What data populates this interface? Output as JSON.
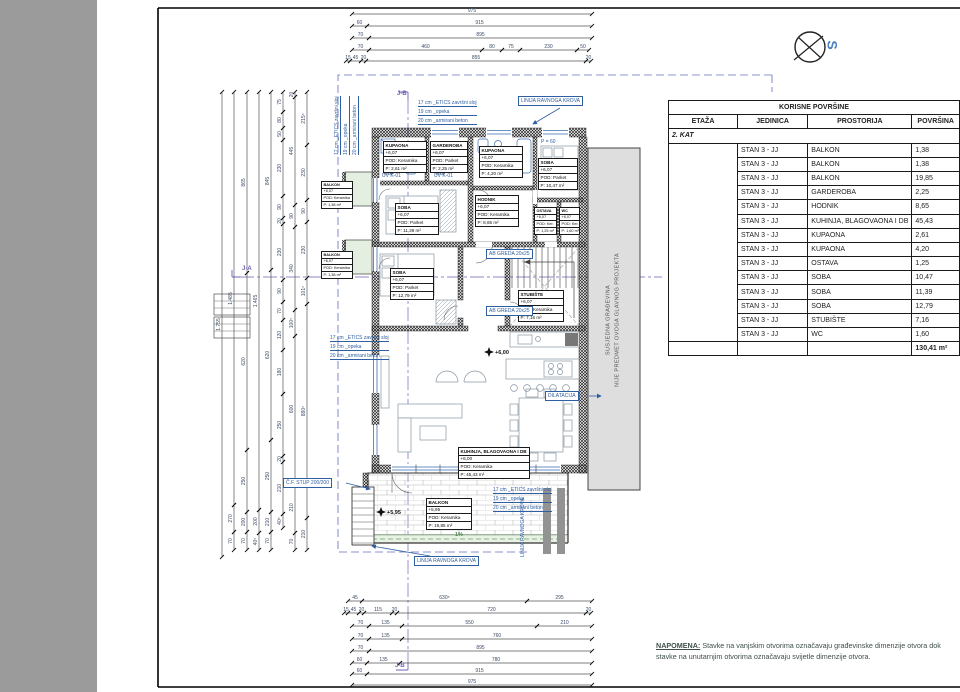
{
  "compass": {
    "label": "S"
  },
  "table": {
    "title": "KORISNE POVRŠINE",
    "headers": [
      "ETAŽA",
      "JEDINICA",
      "PROSTORIJA",
      "POVRŠINA"
    ],
    "section": "2. KAT",
    "rows": [
      {
        "unit": "STAN 3 - JJ",
        "room": "BALKON",
        "area": "1,38"
      },
      {
        "unit": "STAN 3 - JJ",
        "room": "BALKON",
        "area": "1,38"
      },
      {
        "unit": "STAN 3 - JJ",
        "room": "BALKON",
        "area": "19,85"
      },
      {
        "unit": "STAN 3 - JJ",
        "room": "GARDEROBA",
        "area": "2,25"
      },
      {
        "unit": "STAN 3 - JJ",
        "room": "HODNIK",
        "area": "8,65"
      },
      {
        "unit": "STAN 3 - JJ",
        "room": "KUHINJA, BLAGOVAONA I DB",
        "area": "45,43"
      },
      {
        "unit": "STAN 3 - JJ",
        "room": "KUPAONA",
        "area": "2,61"
      },
      {
        "unit": "STAN 3 - JJ",
        "room": "KUPAONA",
        "area": "4,20"
      },
      {
        "unit": "STAN 3 - JJ",
        "room": "OSTAVA",
        "area": "1,25"
      },
      {
        "unit": "STAN 3 - JJ",
        "room": "SOBA",
        "area": "10,47"
      },
      {
        "unit": "STAN 3 - JJ",
        "room": "SOBA",
        "area": "11,39"
      },
      {
        "unit": "STAN 3 - JJ",
        "room": "SOBA",
        "area": "12,79"
      },
      {
        "unit": "STAN 3 - JJ",
        "room": "STUBIŠTE",
        "area": "7,16"
      },
      {
        "unit": "STAN 3 - JJ",
        "room": "WC",
        "area": "1,60"
      }
    ],
    "total": "130,41 m²",
    "total_color": "#ee5a70"
  },
  "note": {
    "label": "NAPOMENA:",
    "text": " Stavke na vanjskim otvorima označavaju građevinske dimenzije otvora dok stavke na unutarnjim otvorima označavaju svijetle dimenzije otvora."
  },
  "plan": {
    "neighbor": {
      "line1": "SUSJEDNA GRAĐEVINA",
      "line2": "NIJE PREDMET OVOGA GLAVNOG PROJEKTA"
    },
    "slope": {
      "text": "1%"
    },
    "levels": [
      {
        "x": 489,
        "y": 352,
        "t": "+6,00"
      },
      {
        "x": 381,
        "y": 512,
        "t": "+5,95"
      }
    ],
    "sections": [
      {
        "text": "J-A",
        "x": 242,
        "y": 266
      },
      {
        "text": "J-B",
        "x": 397,
        "y": 91
      },
      {
        "text": "J-B",
        "x": 395,
        "y": 663
      }
    ],
    "room_labels": [
      {
        "x": 383,
        "y": 141,
        "w": 42,
        "name": "KUPAONA",
        "level": "+6,07",
        "floor": "POD: Keramika",
        "area": "P: 2,61 m²"
      },
      {
        "x": 430,
        "y": 141,
        "w": 36,
        "name": "GARDEROBA",
        "level": "+6,07",
        "floor": "POD: Parket",
        "area": "P: 2,25 m²"
      },
      {
        "x": 479,
        "y": 146,
        "w": 42,
        "name": "KUPAONA",
        "level": "+6,07",
        "floor": "POD: Keramika",
        "area": "P: 4,20 m²"
      },
      {
        "x": 538,
        "y": 158,
        "w": 38,
        "name": "SOBA",
        "level": "+6,07",
        "floor": "POD: Parket",
        "area": "P: 10,47 m²"
      },
      {
        "x": 395,
        "y": 203,
        "w": 42,
        "name": "SOBA",
        "level": "+6,07",
        "floor": "POD: Parket",
        "area": "P: 11,39 m²"
      },
      {
        "x": 390,
        "y": 268,
        "w": 42,
        "name": "SOBA",
        "level": "+6,07",
        "floor": "POD: Parket",
        "area": "P: 12,79 m²"
      },
      {
        "x": 475,
        "y": 195,
        "w": 42,
        "name": "HODNIK",
        "level": "+6,07",
        "floor": "POD: Keramika",
        "area": "P: 8,65 m²"
      },
      {
        "x": 518,
        "y": 290,
        "w": 44,
        "name": "STUBIŠTE",
        "level": "+6,07",
        "floor": "POD: Keramika",
        "area": "P: 7,16 m²"
      },
      {
        "x": 534,
        "y": 207,
        "w": 21,
        "fs": 3.8,
        "name": "OSTAVA",
        "level": "+6,07",
        "floor": "POD: Ker.",
        "area": "P: 1,25 m²"
      },
      {
        "x": 559,
        "y": 207,
        "w": 19,
        "fs": 3.8,
        "name": "WC",
        "level": "+6,07",
        "floor": "POD: Ker.",
        "area": "P: 1,60 m²"
      },
      {
        "x": 458,
        "y": 447,
        "w": 70,
        "name": "KUHINJA, BLAGOVAONA I DB",
        "level": "+6,00",
        "floor": "POD: Keramika",
        "area": "P: 45,43 m²"
      },
      {
        "x": 426,
        "y": 498,
        "w": 44,
        "name": "BALKON",
        "level": "+5,95",
        "floor": "POD: Keramika",
        "area": "P: 19,85 m²"
      },
      {
        "x": 321,
        "y": 181,
        "w": 30,
        "fs": 3.8,
        "name": "BALKON",
        "level": "+6,07",
        "floor": "POD: Keramika",
        "area": "P: 1,38 m²"
      },
      {
        "x": 321,
        "y": 251,
        "w": 30,
        "fs": 3.8,
        "name": "BALKON",
        "level": "+6,07",
        "floor": "POD: Keramika",
        "area": "P: 1,38 m²"
      }
    ],
    "callouts": [
      {
        "type": "box",
        "x": 518,
        "y": 96,
        "text": "LINIJA RAVNOGA KROVA"
      },
      {
        "type": "box",
        "x": 414,
        "y": 556,
        "text": "LINIJA RAVNOGA KROVA"
      },
      {
        "type": "vert",
        "x": 520,
        "y": 498,
        "text": "LINIJA RAVNOGA KROVA"
      },
      {
        "type": "box",
        "x": 545,
        "y": 391,
        "text": "DILATACIJA"
      },
      {
        "type": "box",
        "x": 283,
        "y": 478,
        "text": "Č.F. STUP 200/200"
      },
      {
        "type": "box",
        "x": 486,
        "y": 249,
        "text": "AB GREDA 20x25"
      },
      {
        "type": "box",
        "x": 486,
        "y": 306,
        "text": "AB GREDA 20x25"
      },
      {
        "type": "plain",
        "x": 382,
        "y": 173,
        "text": "UV K-01"
      },
      {
        "type": "plain",
        "x": 434,
        "y": 173,
        "text": "UV K-01"
      },
      {
        "type": "plain",
        "x": 541,
        "y": 139,
        "text": "P = 60"
      },
      {
        "type": "lines",
        "x": 418,
        "y": 100,
        "lines": [
          "17 cm _ETICS završni sloj",
          "19 cm _opeka",
          "20 cm _armirani beton"
        ]
      },
      {
        "type": "lines",
        "x": 330,
        "y": 335,
        "lines": [
          "17 cm _ETICS završni sloj",
          "19 cm _opeka",
          "20 cm _armirani beton"
        ]
      },
      {
        "type": "lines",
        "x": 493,
        "y": 487,
        "lines": [
          "17 cm _ETICS završni sloj",
          "19 cm _opeka",
          "20 cm _armirani beton"
        ]
      },
      {
        "type": "vlines",
        "x": 334,
        "y": 155,
        "lines": [
          "17 cm _ETICS završni sloj",
          "19 cm _opeka",
          "20 cm _armirani beton"
        ]
      }
    ]
  },
  "dimensions": {
    "top": [
      {
        "y": 14,
        "segs": [
          {
            "a": 352,
            "b": 592,
            "t": "975"
          }
        ]
      },
      {
        "y": 26,
        "segs": [
          {
            "a": 352,
            "b": 367,
            "t": "60"
          },
          {
            "a": 367,
            "b": 592,
            "t": "915"
          }
        ]
      },
      {
        "y": 38,
        "segs": [
          {
            "a": 352,
            "b": 369,
            "t": "70"
          },
          {
            "a": 369,
            "b": 592,
            "t": "895"
          }
        ]
      },
      {
        "y": 50,
        "segs": [
          {
            "a": 352,
            "b": 369,
            "t": "70"
          },
          {
            "a": 369,
            "b": 482,
            "t": "460"
          },
          {
            "a": 482,
            "b": 502,
            "t": "80"
          },
          {
            "a": 502,
            "b": 520,
            "t": "75"
          },
          {
            "a": 520,
            "b": 577,
            "t": "230"
          },
          {
            "a": 577,
            "b": 589,
            "t": "50"
          }
        ]
      },
      {
        "y": 61,
        "segs": [
          {
            "a": 346,
            "b": 350,
            "t": "15"
          },
          {
            "a": 350,
            "b": 361,
            "t": "45"
          },
          {
            "a": 361,
            "b": 366,
            "t": "20"
          },
          {
            "a": 366,
            "b": 586,
            "t": "855"
          },
          {
            "a": 586,
            "b": 591,
            "t": "20"
          }
        ]
      }
    ],
    "bottom": [
      {
        "y": 601,
        "segs": [
          {
            "a": 348,
            "b": 362,
            "t": "45"
          },
          {
            "a": 362,
            "b": 527,
            "t": "630⁵"
          },
          {
            "a": 527,
            "b": 592,
            "t": "295"
          }
        ]
      },
      {
        "y": 613,
        "segs": [
          {
            "a": 344,
            "b": 348,
            "t": "15"
          },
          {
            "a": 348,
            "b": 359,
            "t": "45"
          },
          {
            "a": 359,
            "b": 364,
            "t": "20"
          },
          {
            "a": 364,
            "b": 392,
            "t": "115"
          },
          {
            "a": 392,
            "b": 397,
            "t": "20"
          },
          {
            "a": 397,
            "b": 586,
            "t": "720"
          },
          {
            "a": 586,
            "b": 591,
            "t": "20"
          }
        ]
      },
      {
        "y": 626,
        "segs": [
          {
            "a": 352,
            "b": 369,
            "t": "70"
          },
          {
            "a": 369,
            "b": 402,
            "t": "135"
          },
          {
            "a": 402,
            "b": 537,
            "t": "550"
          },
          {
            "a": 537,
            "b": 592,
            "t": "210"
          }
        ]
      },
      {
        "y": 639,
        "segs": [
          {
            "a": 352,
            "b": 369,
            "t": "70"
          },
          {
            "a": 369,
            "b": 402,
            "t": "135"
          },
          {
            "a": 402,
            "b": 592,
            "t": "760"
          }
        ]
      },
      {
        "y": 651,
        "segs": [
          {
            "a": 352,
            "b": 369,
            "t": "70"
          },
          {
            "a": 369,
            "b": 592,
            "t": "895"
          }
        ]
      },
      {
        "y": 663,
        "segs": [
          {
            "a": 352,
            "b": 367,
            "t": "60"
          },
          {
            "a": 367,
            "b": 400,
            "t": "135"
          },
          {
            "a": 400,
            "b": 592,
            "t": "780"
          }
        ]
      },
      {
        "y": 674,
        "segs": [
          {
            "a": 352,
            "b": 367,
            "t": "60"
          },
          {
            "a": 367,
            "b": 592,
            "t": "915"
          }
        ]
      },
      {
        "y": 685,
        "segs": [
          {
            "a": 352,
            "b": 592,
            "t": "975"
          }
        ]
      }
    ],
    "left": [
      {
        "x": 222,
        "segs": [
          {
            "a": 92,
            "b": 557,
            "t": "1.755"
          }
        ]
      },
      {
        "x": 234,
        "segs": [
          {
            "a": 92,
            "b": 505,
            "t": "1.485"
          },
          {
            "a": 505,
            "b": 532,
            "t": "270"
          },
          {
            "a": 532,
            "b": 550,
            "t": "70"
          }
        ]
      },
      {
        "x": 247,
        "segs": [
          {
            "a": 92,
            "b": 273,
            "t": "865"
          },
          {
            "a": 273,
            "b": 450,
            "t": "620"
          },
          {
            "a": 450,
            "b": 512,
            "t": "250"
          },
          {
            "a": 512,
            "b": 532,
            "t": "200"
          },
          {
            "a": 532,
            "b": 550,
            "t": "70"
          }
        ]
      },
      {
        "x": 259,
        "segs": [
          {
            "a": 92,
            "b": 510,
            "t": "1.465"
          },
          {
            "a": 510,
            "b": 533,
            "t": "200"
          },
          {
            "a": 533,
            "b": 550,
            "t": "40⁵"
          }
        ]
      },
      {
        "x": 271,
        "segs": [
          {
            "a": 92,
            "b": 270,
            "t": "845"
          },
          {
            "a": 270,
            "b": 440,
            "t": "620"
          },
          {
            "a": 440,
            "b": 512,
            "t": "250"
          },
          {
            "a": 512,
            "b": 532,
            "t": "210"
          },
          {
            "a": 532,
            "b": 550,
            "t": "70"
          }
        ]
      },
      {
        "x": 283,
        "segs": [
          {
            "a": 92,
            "b": 112,
            "t": "75"
          },
          {
            "a": 112,
            "b": 128,
            "t": "80"
          },
          {
            "a": 128,
            "b": 140,
            "t": "50"
          },
          {
            "a": 140,
            "b": 196,
            "t": "230"
          },
          {
            "a": 196,
            "b": 218,
            "t": "90"
          },
          {
            "a": 218,
            "b": 224,
            "t": "20"
          },
          {
            "a": 224,
            "b": 280,
            "t": "230"
          },
          {
            "a": 280,
            "b": 302,
            "t": "90"
          },
          {
            "a": 302,
            "b": 320,
            "t": "70"
          },
          {
            "a": 320,
            "b": 350,
            "t": "120"
          },
          {
            "a": 350,
            "b": 394,
            "t": "180"
          },
          {
            "a": 394,
            "b": 456,
            "t": "250"
          },
          {
            "a": 456,
            "b": 462,
            "t": "20"
          },
          {
            "a": 462,
            "b": 514,
            "t": "210"
          },
          {
            "a": 514,
            "b": 528,
            "t": "40⁵"
          }
        ]
      },
      {
        "x": 295,
        "segs": [
          {
            "a": 92,
            "b": 97,
            "t": "20"
          },
          {
            "a": 97,
            "b": 205,
            "t": "445"
          },
          {
            "a": 205,
            "b": 227,
            "t": "90"
          },
          {
            "a": 227,
            "b": 310,
            "t": "340"
          },
          {
            "a": 310,
            "b": 336,
            "t": "100⁵"
          },
          {
            "a": 336,
            "b": 482,
            "t": "600"
          },
          {
            "a": 482,
            "b": 533,
            "t": "210"
          },
          {
            "a": 533,
            "b": 550,
            "t": "70"
          }
        ]
      },
      {
        "x": 307,
        "segs": [
          {
            "a": 92,
            "b": 145,
            "t": "215⁵"
          },
          {
            "a": 145,
            "b": 200,
            "t": "230"
          },
          {
            "a": 200,
            "b": 222,
            "t": "90"
          },
          {
            "a": 222,
            "b": 278,
            "t": "230"
          },
          {
            "a": 278,
            "b": 304,
            "t": "101⁵"
          },
          {
            "a": 304,
            "b": 518,
            "t": "880⁵"
          },
          {
            "a": 518,
            "b": 550,
            "t": "210"
          }
        ]
      }
    ]
  }
}
